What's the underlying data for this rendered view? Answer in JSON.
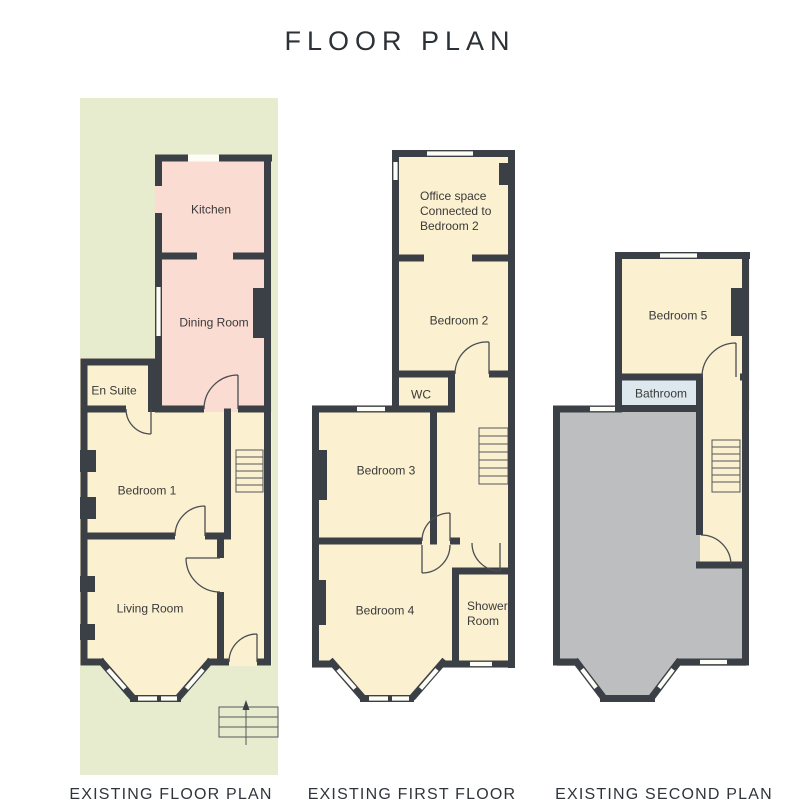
{
  "title": "FLOOR PLAN",
  "colors": {
    "wall": "#3b4046",
    "room": "#fbf0cf",
    "annex": "#fadcd2",
    "garden": "#e7ecce",
    "void": "#bdbec0",
    "bathroom": "#dde8ee"
  },
  "plans": [
    {
      "id": "ground",
      "caption": "EXISTING FLOOR PLAN",
      "rooms": [
        {
          "label": "Kitchen"
        },
        {
          "label": "Dining Room"
        },
        {
          "label": "En Suite"
        },
        {
          "label": "Bedroom 1"
        },
        {
          "label": "Living Room"
        }
      ]
    },
    {
      "id": "first",
      "caption": "EXISTING FIRST FLOOR",
      "rooms": [
        {
          "label": "Office space\nConnected to\nBedroom 2"
        },
        {
          "label": "Bedroom 2"
        },
        {
          "label": "WC"
        },
        {
          "label": "Bedroom 3"
        },
        {
          "label": "Bedroom 4"
        },
        {
          "label": "Shower\nRoom"
        }
      ]
    },
    {
      "id": "second",
      "caption": "EXISTING SECOND PLAN",
      "rooms": [
        {
          "label": "Bedroom 5"
        },
        {
          "label": "Bathroom"
        }
      ]
    }
  ]
}
